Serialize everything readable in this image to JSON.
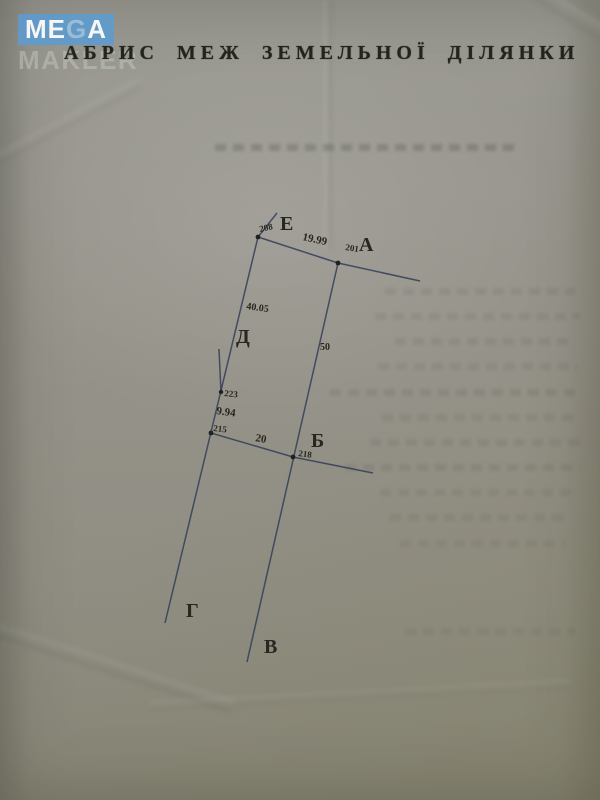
{
  "watermark": {
    "mega_me": "ME",
    "mega_g": "G",
    "mega_a": "A",
    "makler": "MAKLER",
    "block_color": "#5f9bce"
  },
  "title": "АБРИС МЕЖ ЗЕМЕЛЬНОЇ ДІЛЯНКИ",
  "diagram": {
    "line_color": "#33415a",
    "points": {
      "E": {
        "label": "Е",
        "number": "208"
      },
      "A": {
        "label": "А",
        "number": "201"
      },
      "B": {
        "label": "Б",
        "number": "218"
      },
      "D": {
        "label": "Д"
      },
      "G": {
        "label": "Г"
      },
      "V": {
        "label": "В"
      },
      "p223": {
        "number": "223"
      },
      "p215": {
        "number": "215"
      }
    },
    "measurements": {
      "E_A": "19.99",
      "E_p223": "40.05",
      "A_B": "50",
      "p223_p215": "9.94",
      "p215_B": "20"
    }
  }
}
